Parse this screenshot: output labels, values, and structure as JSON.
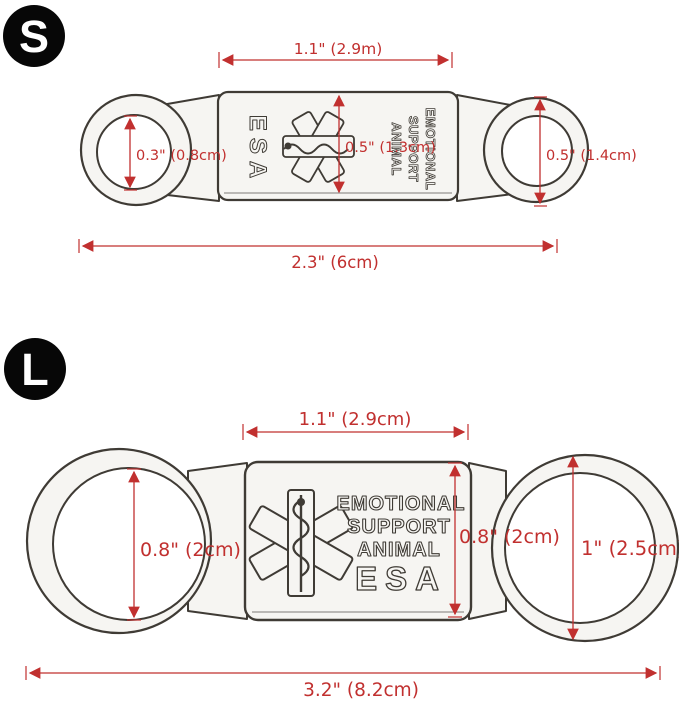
{
  "colors": {
    "dimension_red": "#c1302f",
    "sketch_outline": "#3f3b35",
    "metal_fill": "#f6f5f2",
    "badge_background": "#070707",
    "badge_text": "#ffffff",
    "page_background": "#ffffff"
  },
  "small": {
    "badge_label": "S",
    "dim_top": "1.1\" (2.9m)",
    "dim_left_hole": "0.3\" (0.8cm)",
    "dim_plate": "0.5\" (1.3cm)",
    "dim_right_hole": "0.5\" (1.4cm)",
    "dim_total": "2.3\" (6cm)",
    "engrave_esa": "ESA",
    "engrave_line1": "EMOTIONAL",
    "engrave_line2": "SUPPORT",
    "engrave_line3": "ANIMAL"
  },
  "large": {
    "badge_label": "L",
    "dim_top": "1.1\" (2.9cm)",
    "dim_left_hole": "0.8\" (2cm)",
    "dim_plate": "0.8\" (2cm)",
    "dim_right_hole": "1\" (2.5cm)",
    "dim_total": "3.2\" (8.2cm)",
    "engrave_line1": "EMOTIONAL",
    "engrave_line2": "SUPPORT",
    "engrave_line3": "ANIMAL",
    "engrave_esa": "ESA"
  }
}
